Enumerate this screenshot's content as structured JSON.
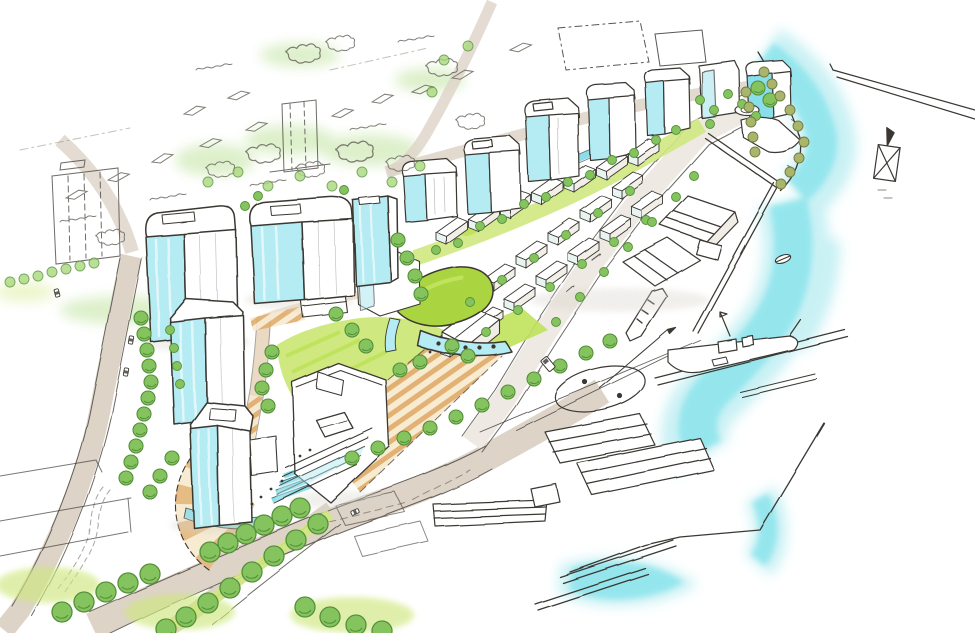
{
  "meta": {
    "kind": "hand-drawn urban waterfront masterplan concept sketch",
    "view": "aerial axonometric perspective",
    "media": "ink pen line work with watercolor marker washes",
    "orientation": "harbour edge runs diagonally from lower-left landside to upper-right open water"
  },
  "palette": {
    "paper": "#ffffff",
    "ink": "#3b3833",
    "ink-light": "#8a8478",
    "water": "#8ce4ec",
    "water-soft": "#c9f1f4",
    "glass": "#b5ebf2",
    "glass-deep": "#8adeea",
    "tree": "#85c35e",
    "tree-dark": "#55903a",
    "tree-light": "#a9d97c",
    "olive": "#a9b56b",
    "lawn": "#cfe87f",
    "lawn-bright": "#bfe35b",
    "roof-lime": "#abd53f",
    "road": "#ddd3c7",
    "road-warm": "#ead9c3",
    "plaza": "#eec37c",
    "plaza-deep": "#db9d52",
    "plaza-pale": "#f7ead0",
    "shadow": "#d8d4cb"
  },
  "scene": {
    "water": {
      "label": "harbour water",
      "features": [
        "soft cyan wash along the shore fading to white",
        "long breakwater line running off the top-right edge",
        "small sailing boat",
        "tiny rowing boat",
        "dock basin"
      ]
    },
    "waterfront": {
      "label": "working quay and docks",
      "features": [
        "wedge-shaped wharf apron",
        "warehouse sheds drawn in plain line",
        "boat on slipway",
        "ship moored at finger pier",
        "painted turning circle with flag mast",
        "bottom shed cluster and piers"
      ]
    },
    "development": {
      "label": "proposed mixed-use quarter",
      "towers": 5,
      "mid_rise_blocks": 5,
      "low_rise_rows": 2,
      "features": [
        "cyan glass tower faces",
        "green linear park spine with canal",
        "green-roof pavilion",
        "terraced building stepping to plaza",
        "orange boardwalk steps to the water",
        "fan-shaped paved plaza",
        "central lawn",
        "water-feature steps",
        "pool at tower base"
      ]
    },
    "landscape": {
      "label": "planting",
      "features": [
        "street tree avenues",
        "tree-lined boulevard",
        "lawn patches",
        "hedge rows",
        "olive scrub on the rocky point"
      ]
    },
    "context": {
      "label": "existing city sketched in outline only",
      "features": [
        "two existing towers in plain line",
        "scribbled housing rooftops",
        "winding access road",
        "dash-outlined future building site"
      ]
    }
  }
}
